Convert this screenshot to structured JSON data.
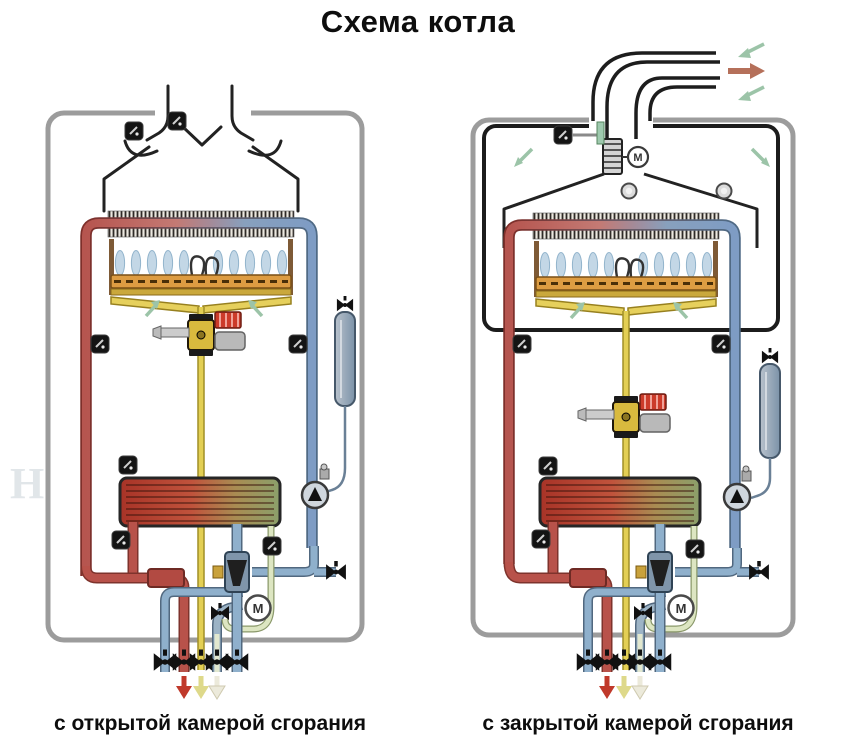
{
  "title": "Схема котла",
  "boilers": {
    "left": {
      "caption": "с открытой камерой сгорания",
      "chamber": "open",
      "motor_label": "M",
      "components": [
        "draft-hood",
        "chimney-deflector",
        "primary-heat-exchanger",
        "atmospheric-burner",
        "ignition-electrodes",
        "gas-valve",
        "gas-pipe",
        "expansion-tank",
        "circulation-pump",
        "secondary-plate-heat-exchanger",
        "three-way-valve",
        "valve-motor",
        "shutoff-valves",
        "temperature-sensors"
      ]
    },
    "right": {
      "caption": "с закрытой камерой сгорания",
      "chamber": "closed",
      "motor_label": "M",
      "fan_label": "M",
      "components": [
        "coaxial-flue",
        "exhaust-fan",
        "sealed-combustion-chamber",
        "sight-windows",
        "primary-heat-exchanger",
        "atmospheric-burner",
        "ignition-electrodes",
        "gas-valve",
        "gas-pipe",
        "expansion-tank",
        "circulation-pump",
        "secondary-plate-heat-exchanger",
        "three-way-valve",
        "valve-motor",
        "shutoff-valves",
        "temperature-sensors"
      ]
    }
  },
  "labels": {
    "motor": "M"
  },
  "watermark": {
    "left": "Н Т",
    "right": "И"
  },
  "colors": {
    "casing_outline": "#9c9c9c",
    "chamber_outline": "#1c1c1c",
    "hot_water_pipe": "#b8524a",
    "cold_return_pipe": "#8fb0cc",
    "gas_pipe": "#e3cf54",
    "dhw_pipe": "#dde6c2",
    "burner_rail": "#dd9c42",
    "manifold": "#e6d05c",
    "flame": "#c3d7e6",
    "air_arrow": "#9cc4a8",
    "exhaust_arrow": "#b5705a",
    "heat_exchanger_hot": "#a83327",
    "heat_exchanger_cool": "#8ba06b",
    "valve_icon": "#111111",
    "tank_body": "#8ea6ba",
    "flow_arrow_red": "#c0392b",
    "flow_arrow_yellow": "#ded98a",
    "flow_arrow_pale": "#eceadb"
  }
}
